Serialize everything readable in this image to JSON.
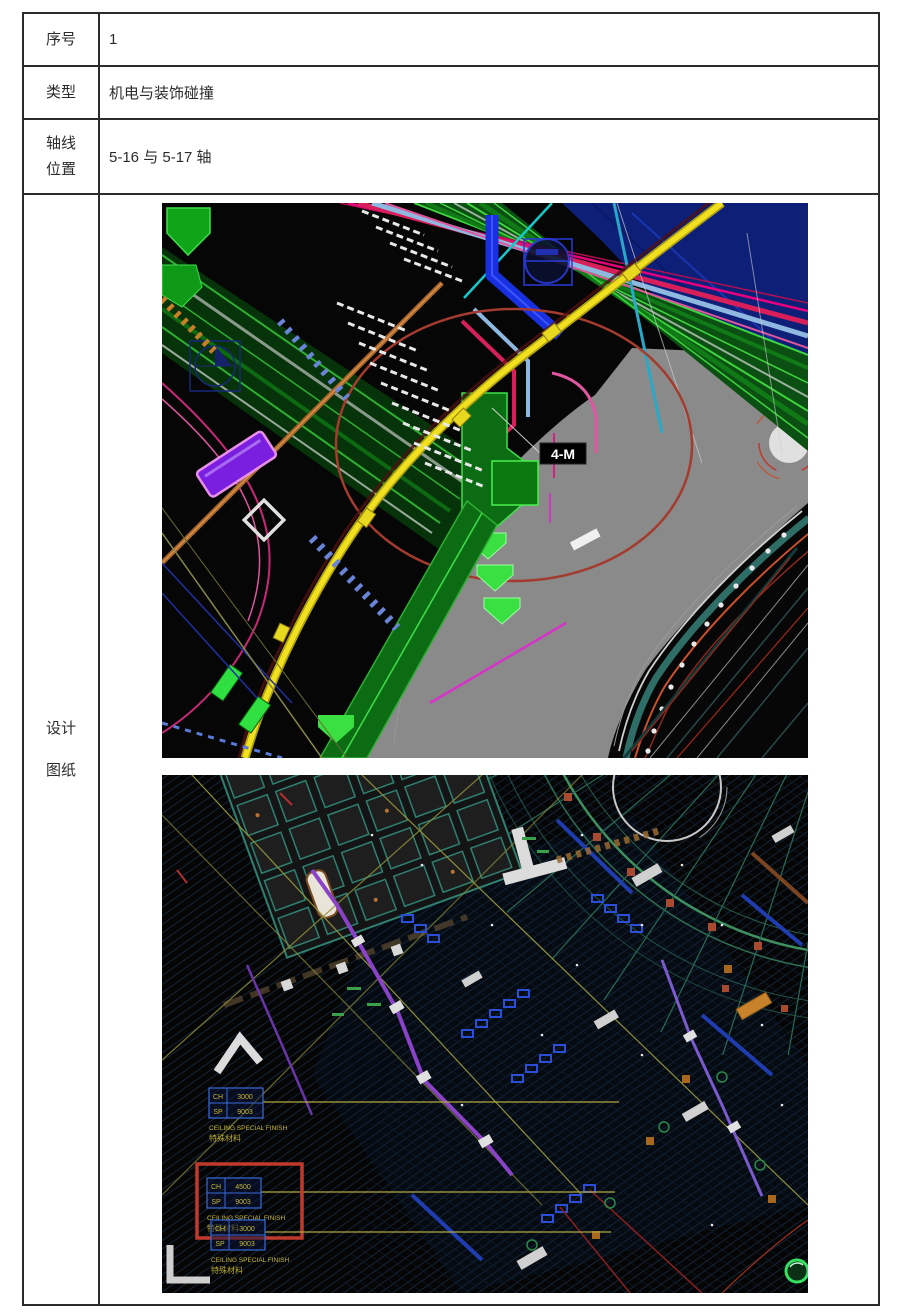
{
  "table": {
    "rows": [
      {
        "label": "序号",
        "value": "1"
      },
      {
        "label": "类型",
        "value": "机电与装饰碰撞"
      },
      {
        "label_line1": "轴线",
        "label_line2": "位置",
        "value": "5-16 与 5-17 轴"
      },
      {
        "label_line1": "设计",
        "label_line2": "图纸"
      }
    ]
  },
  "cad_top": {
    "collision_tag": "4-M"
  },
  "cad_bottom": {
    "finish_tags": [
      {
        "row1_key": "CH",
        "row1_val": "3000",
        "row2_key": "SP",
        "row2_val": "9003",
        "caption_en": "CEILING SPECIAL FINISH",
        "caption_zh": "特殊材料",
        "highlighted": false
      },
      {
        "row1_key": "CH",
        "row1_val": "4500",
        "row2_key": "SP",
        "row2_val": "9003",
        "caption_en": "CEILING SPECIAL FINISH",
        "caption_zh": "特殊材料",
        "highlighted": true
      },
      {
        "row1_key": "CH",
        "row1_val": "3000",
        "row2_key": "SP",
        "row2_val": "9003",
        "caption_en": "CEILING SPECIAL FINISH",
        "caption_zh": "特殊材料",
        "highlighted": false
      }
    ]
  },
  "colors": {
    "pipe_yellow": "#ecd81e",
    "duct_green": "#17a81f",
    "collision_circle_red": "#a33b2e",
    "annotation_blue": "#2030d8",
    "highlight_box_red": "#c0392b",
    "tag_text_yellow": "#c8b838",
    "road_gray": "#8a8a8a",
    "deep_navy": "#0e1f78"
  }
}
